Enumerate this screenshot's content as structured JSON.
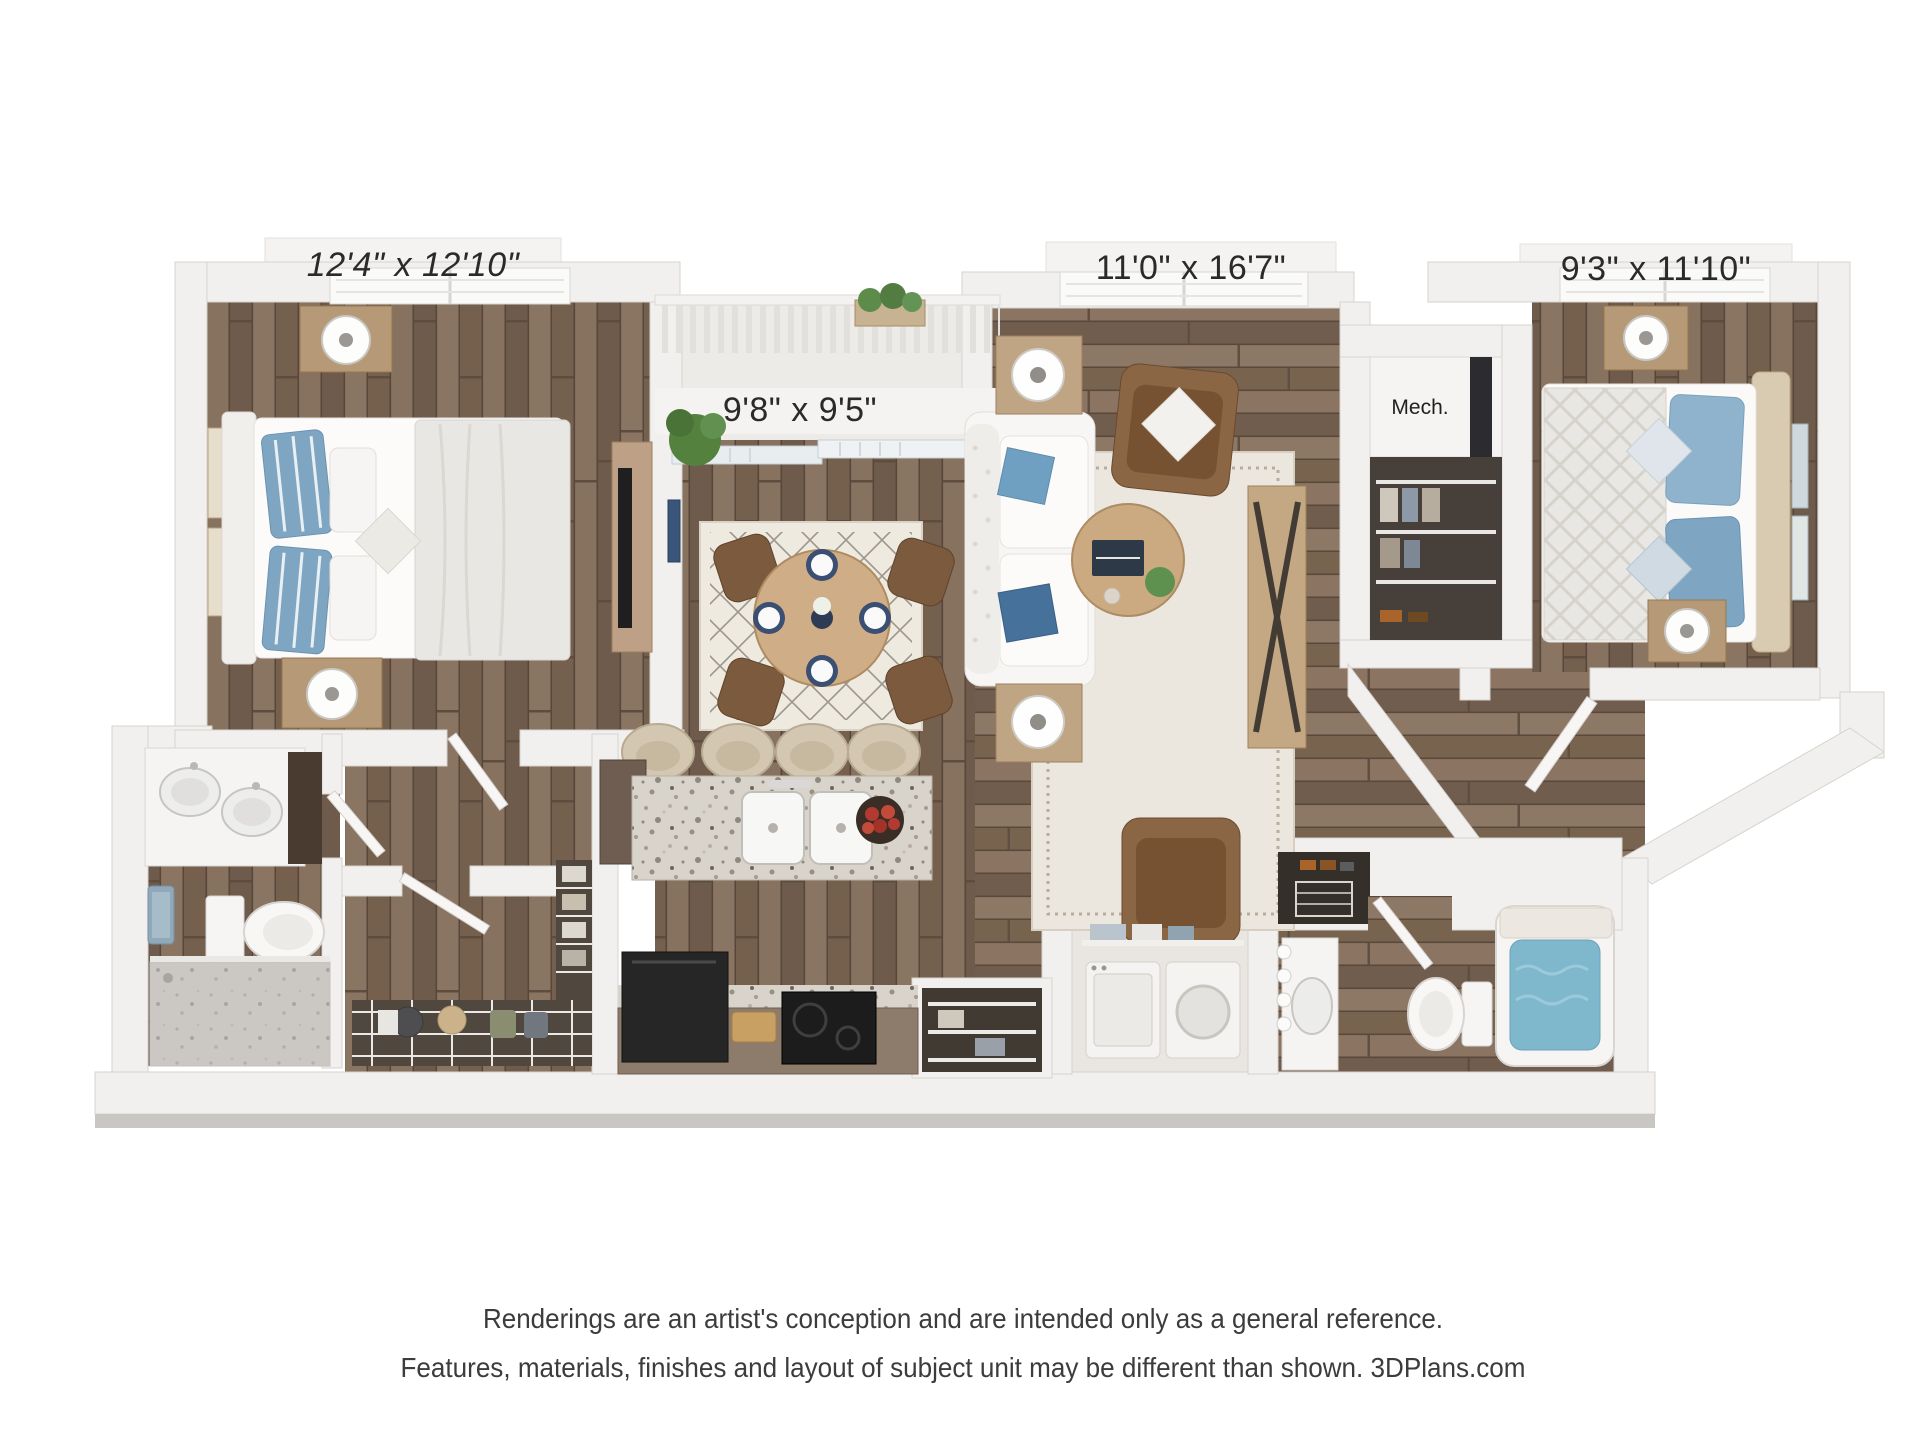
{
  "page": {
    "background": "#ffffff",
    "kind": "3D floor plan rendering"
  },
  "floor_plan": {
    "labels": {
      "bedroom1_dims": "12'4\" x 12'10\"",
      "living_dims": "11'0\" x 16'7\"",
      "bedroom2_dims": "9'3\" x 11'10\"",
      "balcony_dims": "9'8\" x 9'5\"",
      "mech": "Mech."
    },
    "rooms": [
      {
        "name": "bedroom-1",
        "dimensions": "12'4\" x 12'10\""
      },
      {
        "name": "living-room",
        "dimensions": "11'0\" x 16'7\""
      },
      {
        "name": "bedroom-2",
        "dimensions": "9'3\" x 11'10\""
      },
      {
        "name": "balcony",
        "dimensions": "9'8\" x 9'5\""
      },
      {
        "name": "mechanical-closet",
        "dimensions": "Mech."
      }
    ],
    "palette": {
      "wall": "#f2f0ee",
      "wall_edge": "#d6d3cf",
      "wood_base": "#7c6757",
      "granite": "#d8d3cb",
      "accent_blue": "#7ea6c3",
      "water_blue": "#7fb7cd",
      "sofa_white": "#f7f6f4",
      "chair_brown": "#8a6645",
      "rug_cream": "#ece7de"
    }
  },
  "disclaimer": {
    "line1": "Renderings are an artist's conception and are intended only as a general reference.",
    "line2": "Features, materials, finishes and layout of subject unit may be different than shown. 3DPlans.com"
  }
}
